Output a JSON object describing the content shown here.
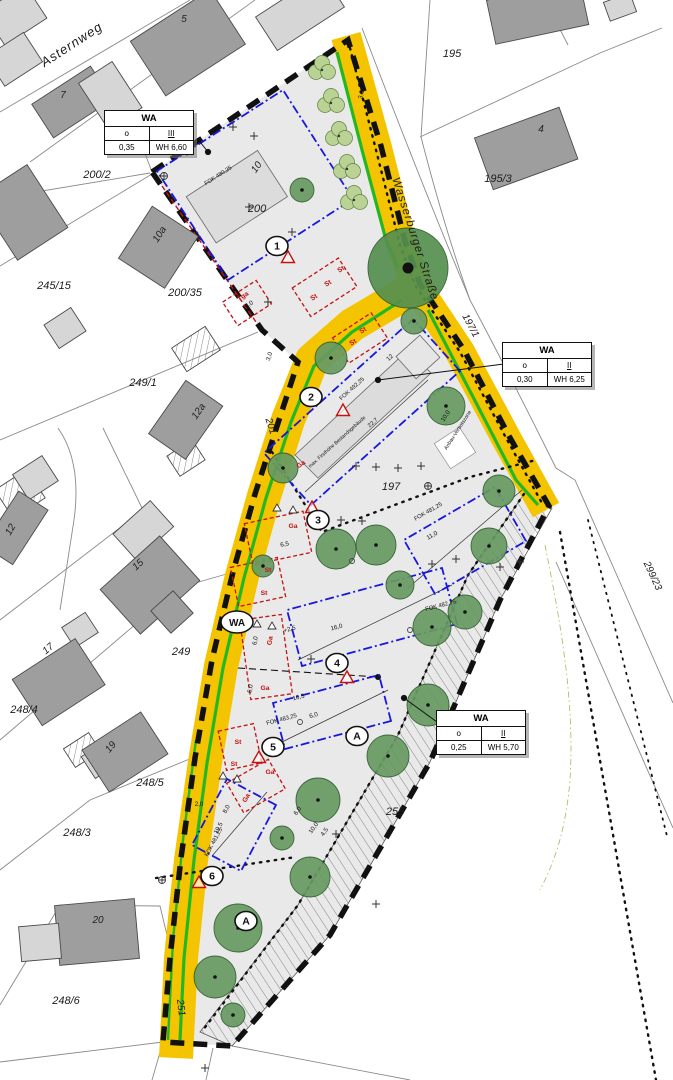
{
  "colors": {
    "road_yellow": "#F5C400",
    "green_edge": "#23B823",
    "plan_area": "#e9e9e9",
    "tree_green": "#679a62",
    "big_tree_green": "#55904f",
    "hedge_green": "#bad394",
    "envelope_blue": "#1818dd",
    "marking_red": "#c41212",
    "building_dark": "#9e9e9e",
    "building_light": "#d6d6d6"
  },
  "wa_boxes": [
    {
      "title": "WA",
      "open": "o",
      "storeys": "III",
      "grz": "0,35",
      "wh": "WH 6,60"
    },
    {
      "title": "WA",
      "open": "o",
      "storeys": "II",
      "grz": "0,30",
      "wh": "WH 6,25"
    },
    {
      "title": "WA",
      "open": "o",
      "storeys": "II",
      "grz": "0,25",
      "wh": "WH 5,70"
    }
  ],
  "road_badge": "WA",
  "streets": [
    {
      "text": "Asternweg",
      "x": 74,
      "y": 48,
      "rot": -33,
      "size": 13
    },
    {
      "text": "Wasserburger Straße",
      "x": 412,
      "y": 240,
      "rot": 72,
      "size": 11.5
    }
  ],
  "parcel_labels": [
    {
      "text": "200/2",
      "x": 97,
      "y": 178,
      "rot": 0,
      "size": 11
    },
    {
      "text": "245/15",
      "x": 54,
      "y": 289,
      "rot": 0,
      "size": 11
    },
    {
      "text": "200/35",
      "x": 185,
      "y": 296,
      "rot": 0,
      "size": 11
    },
    {
      "text": "249/1",
      "x": 143,
      "y": 386,
      "rot": 0,
      "size": 11
    },
    {
      "text": "249",
      "x": 181,
      "y": 655,
      "rot": 0,
      "size": 11
    },
    {
      "text": "248/4",
      "x": 24,
      "y": 713,
      "rot": 0,
      "size": 11
    },
    {
      "text": "248/5",
      "x": 150,
      "y": 786,
      "rot": 0,
      "size": 11
    },
    {
      "text": "248/3",
      "x": 77,
      "y": 836,
      "rot": 0,
      "size": 11
    },
    {
      "text": "248/6",
      "x": 66,
      "y": 1004,
      "rot": 0,
      "size": 11
    },
    {
      "text": "251",
      "x": 178,
      "y": 1008,
      "rot": 83,
      "size": 10
    },
    {
      "text": "201",
      "x": 268,
      "y": 427,
      "rot": 72,
      "size": 10
    },
    {
      "text": "197",
      "x": 391,
      "y": 490,
      "rot": 0,
      "size": 11
    },
    {
      "text": "197/1",
      "x": 468,
      "y": 327,
      "rot": 62,
      "size": 10
    },
    {
      "text": "195",
      "x": 452,
      "y": 57,
      "rot": 0,
      "size": 11
    },
    {
      "text": "195/3",
      "x": 498,
      "y": 182,
      "rot": 0,
      "size": 11
    },
    {
      "text": "200",
      "x": 257,
      "y": 212,
      "rot": 0,
      "size": 11
    },
    {
      "text": "255",
      "x": 395,
      "y": 815,
      "rot": 0,
      "size": 11
    },
    {
      "text": "299/23",
      "x": 650,
      "y": 577,
      "rot": 65,
      "size": 10
    }
  ],
  "house_numbers": [
    {
      "text": "5",
      "x": 184,
      "y": 22,
      "rot": 0,
      "size": 10
    },
    {
      "text": "7",
      "x": 63,
      "y": 98,
      "rot": 0,
      "size": 10
    },
    {
      "text": "10a",
      "x": 162,
      "y": 236,
      "rot": -57,
      "size": 10
    },
    {
      "text": "12a",
      "x": 201,
      "y": 413,
      "rot": -55,
      "size": 10
    },
    {
      "text": "12",
      "x": 13,
      "y": 531,
      "rot": -60,
      "size": 10
    },
    {
      "text": "15",
      "x": 140,
      "y": 567,
      "rot": -42,
      "size": 10
    },
    {
      "text": "17",
      "x": 50,
      "y": 651,
      "rot": -40,
      "size": 10
    },
    {
      "text": "19",
      "x": 113,
      "y": 749,
      "rot": -50,
      "size": 10
    },
    {
      "text": "20",
      "x": 98,
      "y": 923,
      "rot": 0,
      "size": 10
    },
    {
      "text": "4",
      "x": 541,
      "y": 132,
      "rot": 0,
      "size": 10
    },
    {
      "text": "10",
      "x": 259,
      "y": 169,
      "rot": -55,
      "size": 10
    }
  ],
  "plan_labels": [
    {
      "text": "FOK 480,25",
      "x": 219,
      "y": 177,
      "rot": -33,
      "size": 5.8
    },
    {
      "text": "FOK 492,25",
      "x": 353,
      "y": 390,
      "rot": -42,
      "size": 5.8
    },
    {
      "text": "max. Firsthöhe Bestandsgebäude",
      "x": 338,
      "y": 443,
      "rot": -42,
      "size": 5
    },
    {
      "text": "22,7",
      "x": 374,
      "y": 424,
      "rot": -42,
      "size": 5.8
    },
    {
      "text": "FOK 481,25",
      "x": 429,
      "y": 513,
      "rot": -30,
      "size": 5.8
    },
    {
      "text": "FOK 482,75",
      "x": 441,
      "y": 607,
      "rot": -15,
      "size": 5.8
    },
    {
      "text": "FOK 483,25",
      "x": 282,
      "y": 721,
      "rot": -15,
      "size": 5.8
    },
    {
      "text": "FOK 481,25",
      "x": 215,
      "y": 843,
      "rot": -62,
      "size": 5.8
    },
    {
      "text": "Anbau-Verbotszone",
      "x": 459,
      "y": 431,
      "rot": -57,
      "size": 5.2
    }
  ],
  "dim_labels": [
    {
      "text": "3,0",
      "x": 363,
      "y": 95,
      "rot": -78
    },
    {
      "text": "3,0",
      "x": 271,
      "y": 357,
      "rot": -72
    },
    {
      "text": "6,0",
      "x": 250,
      "y": 306,
      "rot": -33
    },
    {
      "text": "12",
      "x": 391,
      "y": 359,
      "rot": -42
    },
    {
      "text": "11,0",
      "x": 433,
      "y": 537,
      "rot": -30
    },
    {
      "text": "16,0",
      "x": 337,
      "y": 629,
      "rot": -15
    },
    {
      "text": "+2,5",
      "x": 290,
      "y": 631,
      "rot": -15
    },
    {
      "text": "10,5",
      "x": 299,
      "y": 699,
      "rot": -15
    },
    {
      "text": "6,0",
      "x": 314,
      "y": 717,
      "rot": -15
    },
    {
      "text": "6,5",
      "x": 285,
      "y": 546,
      "rot": -12
    },
    {
      "text": "6,0",
      "x": 257,
      "y": 641,
      "rot": -80
    },
    {
      "text": "6,0",
      "x": 252,
      "y": 689,
      "rot": -80
    },
    {
      "text": "8,0",
      "x": 228,
      "y": 810,
      "rot": -62
    },
    {
      "text": "19,5",
      "x": 220,
      "y": 829,
      "rot": -62
    },
    {
      "text": "2,0",
      "x": 199,
      "y": 806,
      "rot": 0
    },
    {
      "text": "6,0",
      "x": 299,
      "y": 812,
      "rot": -55
    },
    {
      "text": "10,0",
      "x": 315,
      "y": 829,
      "rot": -55
    },
    {
      "text": "4,5",
      "x": 326,
      "y": 833,
      "rot": -55
    },
    {
      "text": "10,0",
      "x": 447,
      "y": 417,
      "rot": -57
    }
  ],
  "red_labels": [
    {
      "text": "Tga",
      "x": 244,
      "y": 298,
      "rot": -33
    },
    {
      "text": "St",
      "x": 342,
      "y": 271,
      "rot": -33
    },
    {
      "text": "St",
      "x": 329,
      "y": 285,
      "rot": -33
    },
    {
      "text": "St",
      "x": 315,
      "y": 299,
      "rot": -33
    },
    {
      "text": "St",
      "x": 364,
      "y": 332,
      "rot": -33
    },
    {
      "text": "St",
      "x": 354,
      "y": 344,
      "rot": -33
    },
    {
      "text": "Ga",
      "x": 302,
      "y": 466,
      "rot": -33
    },
    {
      "text": "Ga",
      "x": 293,
      "y": 528,
      "rot": 0
    },
    {
      "text": "St",
      "x": 268,
      "y": 572,
      "rot": 0
    },
    {
      "text": "St",
      "x": 264,
      "y": 595,
      "rot": 0
    },
    {
      "text": "Ga",
      "x": 272,
      "y": 641,
      "rot": -80
    },
    {
      "text": "Ga",
      "x": 265,
      "y": 690,
      "rot": 0
    },
    {
      "text": "St",
      "x": 238,
      "y": 744,
      "rot": 0
    },
    {
      "text": "St",
      "x": 234,
      "y": 766,
      "rot": 0
    },
    {
      "text": "Ga",
      "x": 270,
      "y": 774,
      "rot": 0
    },
    {
      "text": "Ga",
      "x": 248,
      "y": 799,
      "rot": -60
    }
  ],
  "markers": [
    {
      "label": "1",
      "x": 277,
      "y": 246
    },
    {
      "label": "2",
      "x": 311,
      "y": 397
    },
    {
      "label": "3",
      "x": 318,
      "y": 520
    },
    {
      "label": "4",
      "x": 337,
      "y": 663
    },
    {
      "label": "5",
      "x": 273,
      "y": 747
    },
    {
      "label": "6",
      "x": 212,
      "y": 876
    },
    {
      "label": "A",
      "x": 357,
      "y": 736
    },
    {
      "label": "A",
      "x": 246,
      "y": 921
    }
  ],
  "warning_triangles": [
    {
      "x": 288,
      "y": 258
    },
    {
      "x": 343,
      "y": 411
    },
    {
      "x": 312,
      "y": 508
    },
    {
      "x": 347,
      "y": 678
    },
    {
      "x": 259,
      "y": 758
    },
    {
      "x": 199,
      "y": 883
    }
  ],
  "trees": [
    {
      "x": 302,
      "y": 190,
      "r": 12
    },
    {
      "x": 408,
      "y": 268,
      "r": 40,
      "big": true
    },
    {
      "x": 414,
      "y": 321,
      "r": 13
    },
    {
      "x": 331,
      "y": 358,
      "r": 16
    },
    {
      "x": 283,
      "y": 468,
      "r": 15
    },
    {
      "x": 446,
      "y": 406,
      "r": 19
    },
    {
      "x": 499,
      "y": 491,
      "r": 16
    },
    {
      "x": 263,
      "y": 566,
      "r": 11
    },
    {
      "x": 336,
      "y": 549,
      "r": 20
    },
    {
      "x": 376,
      "y": 545,
      "r": 20
    },
    {
      "x": 400,
      "y": 585,
      "r": 14
    },
    {
      "x": 432,
      "y": 627,
      "r": 19
    },
    {
      "x": 489,
      "y": 546,
      "r": 18
    },
    {
      "x": 465,
      "y": 612,
      "r": 17
    },
    {
      "x": 428,
      "y": 705,
      "r": 21
    },
    {
      "x": 388,
      "y": 756,
      "r": 21
    },
    {
      "x": 318,
      "y": 800,
      "r": 22
    },
    {
      "x": 282,
      "y": 838,
      "r": 12
    },
    {
      "x": 310,
      "y": 877,
      "r": 20
    },
    {
      "x": 238,
      "y": 928,
      "r": 24
    },
    {
      "x": 215,
      "y": 977,
      "r": 21
    },
    {
      "x": 233,
      "y": 1015,
      "r": 12
    }
  ],
  "hedges": [
    {
      "x": 322,
      "y": 68
    },
    {
      "x": 331,
      "y": 101
    },
    {
      "x": 339,
      "y": 134
    },
    {
      "x": 347,
      "y": 167
    },
    {
      "x": 354,
      "y": 198
    }
  ]
}
